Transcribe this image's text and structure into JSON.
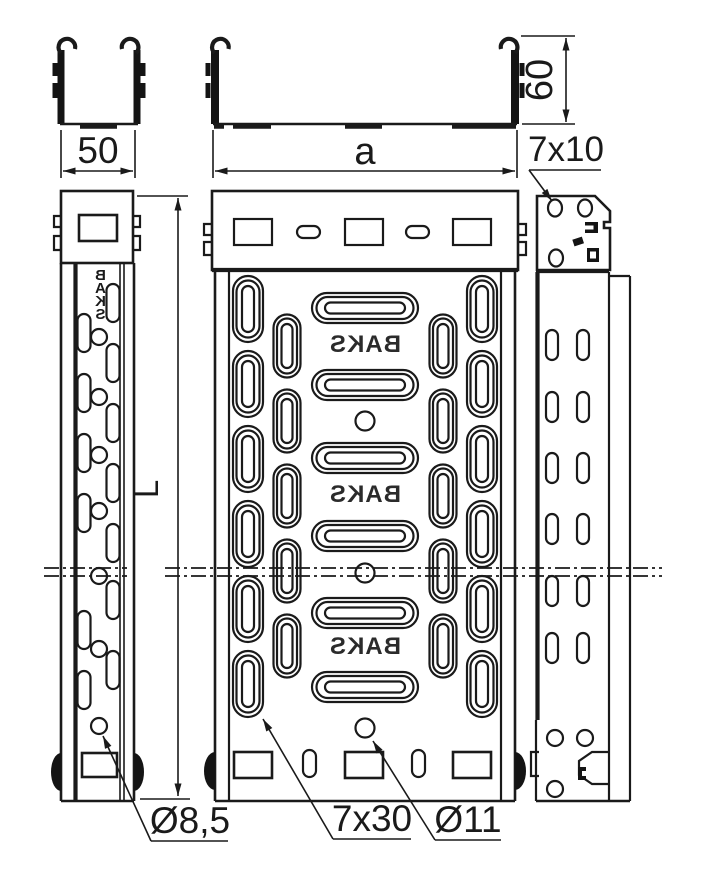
{
  "drawing": {
    "dimensions": {
      "width_small": "50",
      "width_main": "a",
      "height": "60",
      "end_slot": "7x10",
      "length": "L",
      "side_hole": "Ø8,5",
      "base_slot": "7x30",
      "base_hole": "Ø11"
    },
    "brand": {
      "plan_marks": [
        "BAKS",
        "BAKS",
        "BAKS"
      ],
      "side_letters": [
        "B",
        "A",
        "K",
        "S"
      ]
    },
    "colors": {
      "line": "#1a1a1a",
      "background": "#ffffff"
    }
  }
}
